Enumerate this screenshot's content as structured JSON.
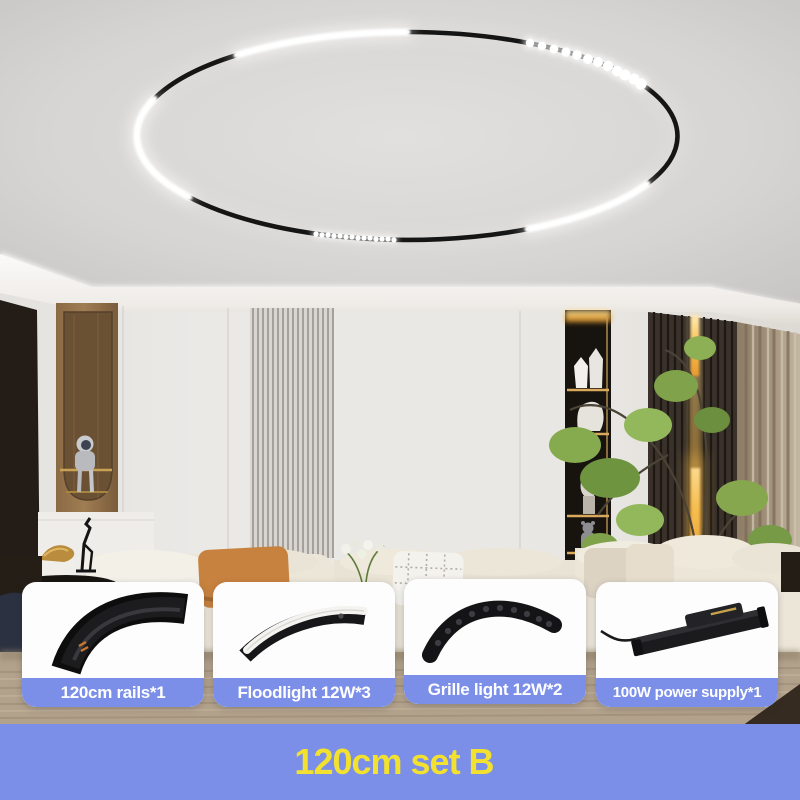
{
  "cards": [
    {
      "label": "120cm rails*1",
      "image": "curved-track-rail"
    },
    {
      "label": "Floodlight 12W*3",
      "image": "curved-floodlight"
    },
    {
      "label": "Grille light 12W*2",
      "image": "curved-grille-light"
    },
    {
      "label": "100W power supply*1",
      "image": "power-supply-with-cable"
    }
  ],
  "banner": {
    "text": "120cm set B"
  },
  "colors": {
    "accent_blue": "#7b8fe8",
    "banner_text_yellow": "#f2e12e",
    "ring_track_black": "#151515",
    "ring_light_white": "#ffffff",
    "warm_led": "#f7bd4e"
  }
}
